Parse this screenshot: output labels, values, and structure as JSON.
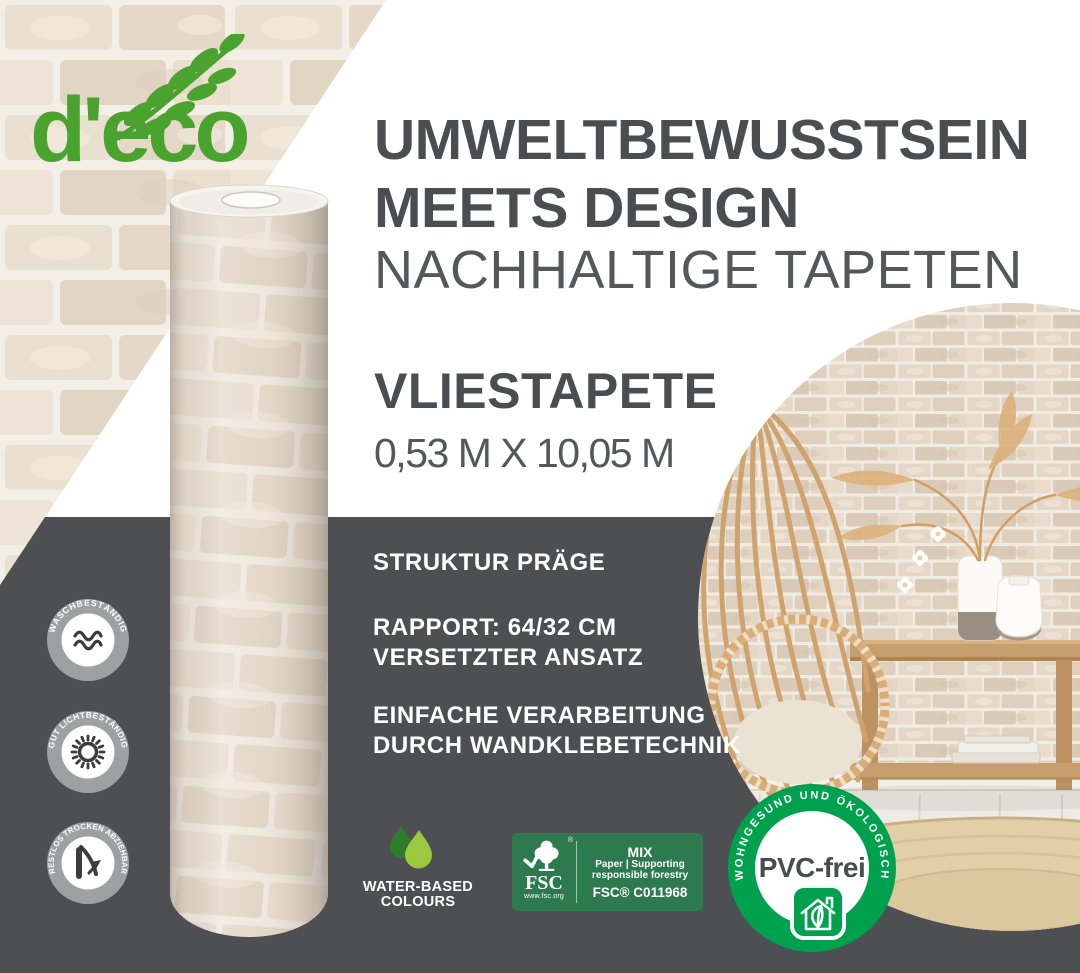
{
  "brand": {
    "logo_text": "d'eco",
    "logo_icon": "leaf-branch-icon"
  },
  "headline": {
    "line1": "UMWELTBEWUSSTSEIN",
    "line2": "MEETS DESIGN",
    "line3": "NACHHALTIGE TAPETEN"
  },
  "product": {
    "name": "VLIESTAPETE",
    "dimensions": "0,53 M X 10,05 M"
  },
  "features": {
    "structure": "STRUKTUR PRÄGE",
    "rapport_line1": "RAPPORT: 64/32 CM",
    "rapport_line2": "VERSETZTER ANSATZ",
    "processing_line1": "EINFACHE VERARBEITUNG",
    "processing_line2": "DURCH WANDKLEBETECHNIK"
  },
  "seals": {
    "washable": {
      "label": "WASCHBESTÄNDIG",
      "icon": "waves-icon"
    },
    "lightfast": {
      "label": "GUT LICHTBESTÄNDIG",
      "icon": "sun-icon"
    },
    "strippable": {
      "label": "RESTLOS TROCKEN ABZIEHBAR",
      "icon": "peel-icon"
    },
    "water_based": {
      "line1": "WATER-BASED",
      "line2": "COLOURS",
      "icon": "water-drops-icon"
    },
    "fsc": {
      "brand": "FSC",
      "registered_mark": "®",
      "website": "www.fsc.org",
      "grade": "MIX",
      "desc_line1": "Paper | Supporting",
      "desc_line2": "responsible forestry",
      "license": "FSC® C011968",
      "icon": "fsc-tree-check-icon"
    },
    "pvc_free": {
      "label": "PVC-frei",
      "ring_text": "WOHNGESUND UND ÖKOLOGISCH",
      "icon": "eco-house-leaf-icon"
    }
  },
  "colors": {
    "logo_green": "#4aa32e",
    "panel_gray": "#4e4f52",
    "heading_gray": "#4b4d50",
    "pvc_green": "#00a14e",
    "fsc_green": "#2c7a4e",
    "drop_light_green": "#9cc83e",
    "drop_dark_green": "#2e7d2f",
    "seal_ring_gray": "#9fa0a2"
  }
}
